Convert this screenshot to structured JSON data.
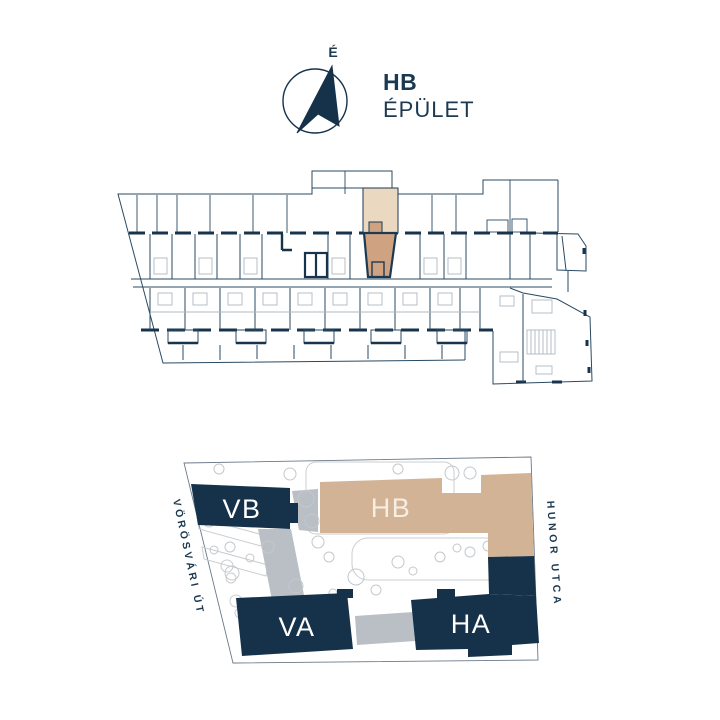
{
  "header": {
    "building_code": "HB",
    "building_name": "ÉPÜLET"
  },
  "compass": {
    "north_label": "É"
  },
  "floor_plan": {
    "description": "floor plan of building HB with one highlighted unit",
    "highlight_colors": {
      "terrace": "#ead8c0",
      "unit": "#cfa382"
    }
  },
  "site_plan": {
    "buildings": [
      {
        "id": "vb",
        "label": "VB",
        "color": "#16324a"
      },
      {
        "id": "hb",
        "label": "HB",
        "color": "#d3b396"
      },
      {
        "id": "va",
        "label": "VA",
        "color": "#16324a"
      },
      {
        "id": "ha",
        "label": "HA",
        "color": "#16324a"
      }
    ],
    "streets": {
      "left": "VÖRÖSVÁRI ÚT",
      "right": "HUNOR UTCA"
    }
  },
  "colors": {
    "navy": "#16324a",
    "line_navy": "#2a4a63",
    "tan": "#d3b396",
    "tan_light": "#ead8c0",
    "tan_dark": "#cfa382",
    "path_gray": "#b9bfc5",
    "garden_gray": "#c9ced2"
  }
}
